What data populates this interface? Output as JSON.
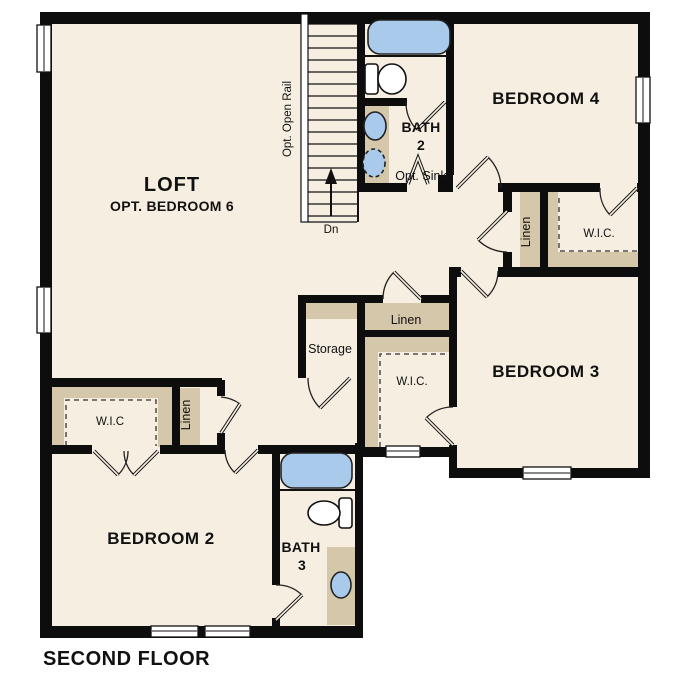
{
  "title": "SECOND FLOOR",
  "colors": {
    "background": "#ffffff",
    "floor": "#f5eee1",
    "wall": "#0d0d0d",
    "closet_tan": "#d5c7aa",
    "fixture_blue": "#a9caea"
  },
  "rooms": {
    "loft": {
      "name": "LOFT",
      "sub": "OPT. BEDROOM 6"
    },
    "bedroom2": {
      "name": "BEDROOM 2"
    },
    "bedroom3": {
      "name": "BEDROOM 3"
    },
    "bedroom4": {
      "name": "BEDROOM 4"
    },
    "bath2": {
      "line1": "BATH",
      "line2": "2",
      "note": "Opt. Sink"
    },
    "bath3": {
      "line1": "BATH",
      "line2": "3"
    }
  },
  "closets": {
    "storage": "Storage",
    "linen_center": "Linen",
    "linen_left": "Linen",
    "linen_right": "Linen",
    "wic_center": "W.I.C.",
    "wic_left": "W.I.C",
    "wic_right": "W.I.C."
  },
  "stairs": {
    "rail": "Opt. Open Rail",
    "down": "Dn"
  }
}
